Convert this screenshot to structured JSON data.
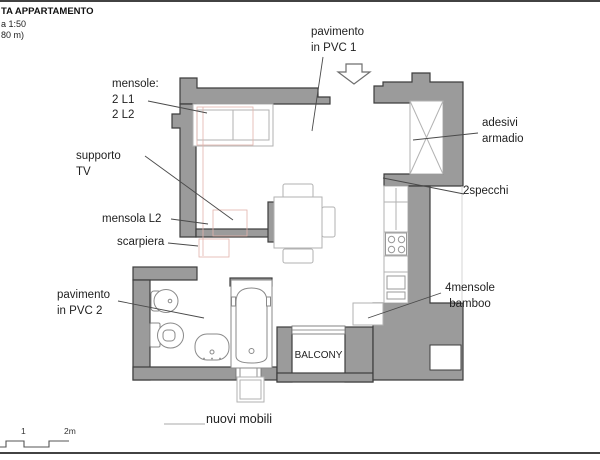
{
  "title_block": {
    "line1": "TA APPARTAMENTO",
    "line2": "a 1:50",
    "line3": "80 m)"
  },
  "labels": {
    "pavimento_pvc1": "pavimento\nin PVC 1",
    "mensole": "mensole:\n2 L1\n2 L2",
    "supporto_tv": "supporto\nTV",
    "mensola_l2": "mensola L2",
    "scarpiera": "scarpiera",
    "pavimento_pvc2": "pavimento\nin PVC 2",
    "adesivi_armadio": "adesivi\narmadio",
    "specchi": "2specchi",
    "mensole_bamboo": "4mensole\nbamboo",
    "balcony": "BALCONY",
    "nuovi_mobili": "nuovi mobili"
  },
  "scale_bar": {
    "tick_1": "1",
    "tick_2": "2m"
  },
  "colors": {
    "wall_fill": "#9b9b9b",
    "wall_outline": "#3d3d3d",
    "furniture_outline": "#b2b2b2",
    "fixture_outline": "#8a8a8a",
    "new_furniture": "#e2b3ab",
    "text": "#1f1f1f"
  }
}
